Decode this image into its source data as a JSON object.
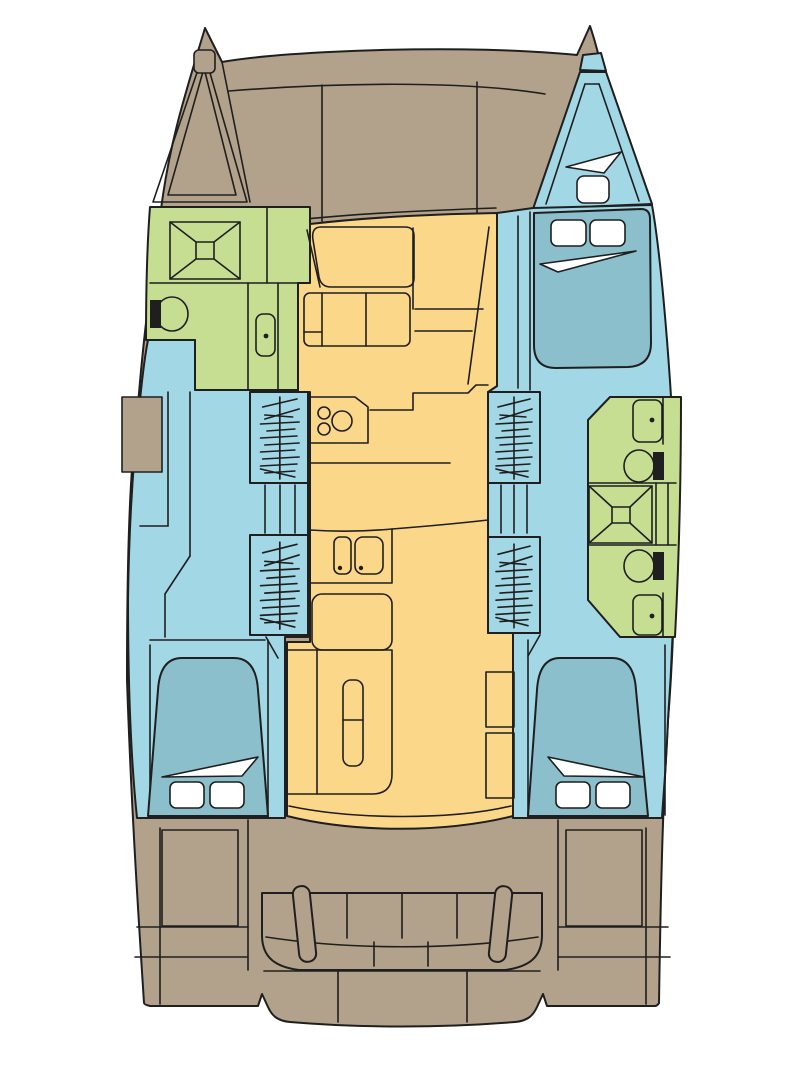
{
  "title": "Catamaran interior layout floor plan",
  "colors": {
    "background": "#ffffff",
    "deck_tan": "#b3a28b",
    "hull_blue": "#a2d7e6",
    "bed_teal": "#8bbfcc",
    "wet_green": "#c6de92",
    "living_yellow": "#fbd78a",
    "outline": "#1f1f1f",
    "white": "#ffffff"
  },
  "color_key": {
    "deck_tan": "exterior decks, cockpit and hull structure",
    "hull_blue": "hull cabins and passageways",
    "bed_teal": "berth mattresses",
    "wet_green": "heads / shower compartments",
    "living_yellow": "saloon and galley living area"
  },
  "regions": [
    {
      "name": "port-bow-anchor-locker"
    },
    {
      "name": "foredeck"
    },
    {
      "name": "starboard-bow-forward-cabin"
    },
    {
      "name": "port-forward-head"
    },
    {
      "name": "port-shower"
    },
    {
      "name": "port-toilet"
    },
    {
      "name": "port-vanity-sink"
    },
    {
      "name": "saloon"
    },
    {
      "name": "saloon-table"
    },
    {
      "name": "saloon-seating"
    },
    {
      "name": "nav-station"
    },
    {
      "name": "galley-stove"
    },
    {
      "name": "galley-double-sink"
    },
    {
      "name": "galley-refrigerator-cabinet"
    },
    {
      "name": "port-wardrobes"
    },
    {
      "name": "port-companionway-steps"
    },
    {
      "name": "starboard-wardrobes"
    },
    {
      "name": "starboard-companionway-steps"
    },
    {
      "name": "starboard-head-forward-toilet"
    },
    {
      "name": "starboard-shower"
    },
    {
      "name": "starboard-head-aft-toilet"
    },
    {
      "name": "port-aft-cabin"
    },
    {
      "name": "starboard-aft-cabin"
    },
    {
      "name": "cockpit"
    },
    {
      "name": "cockpit-bench"
    },
    {
      "name": "cockpit-lockers"
    },
    {
      "name": "transom-platform"
    }
  ],
  "berth_count": 4,
  "shower_count": 2,
  "toilet_count": 3
}
